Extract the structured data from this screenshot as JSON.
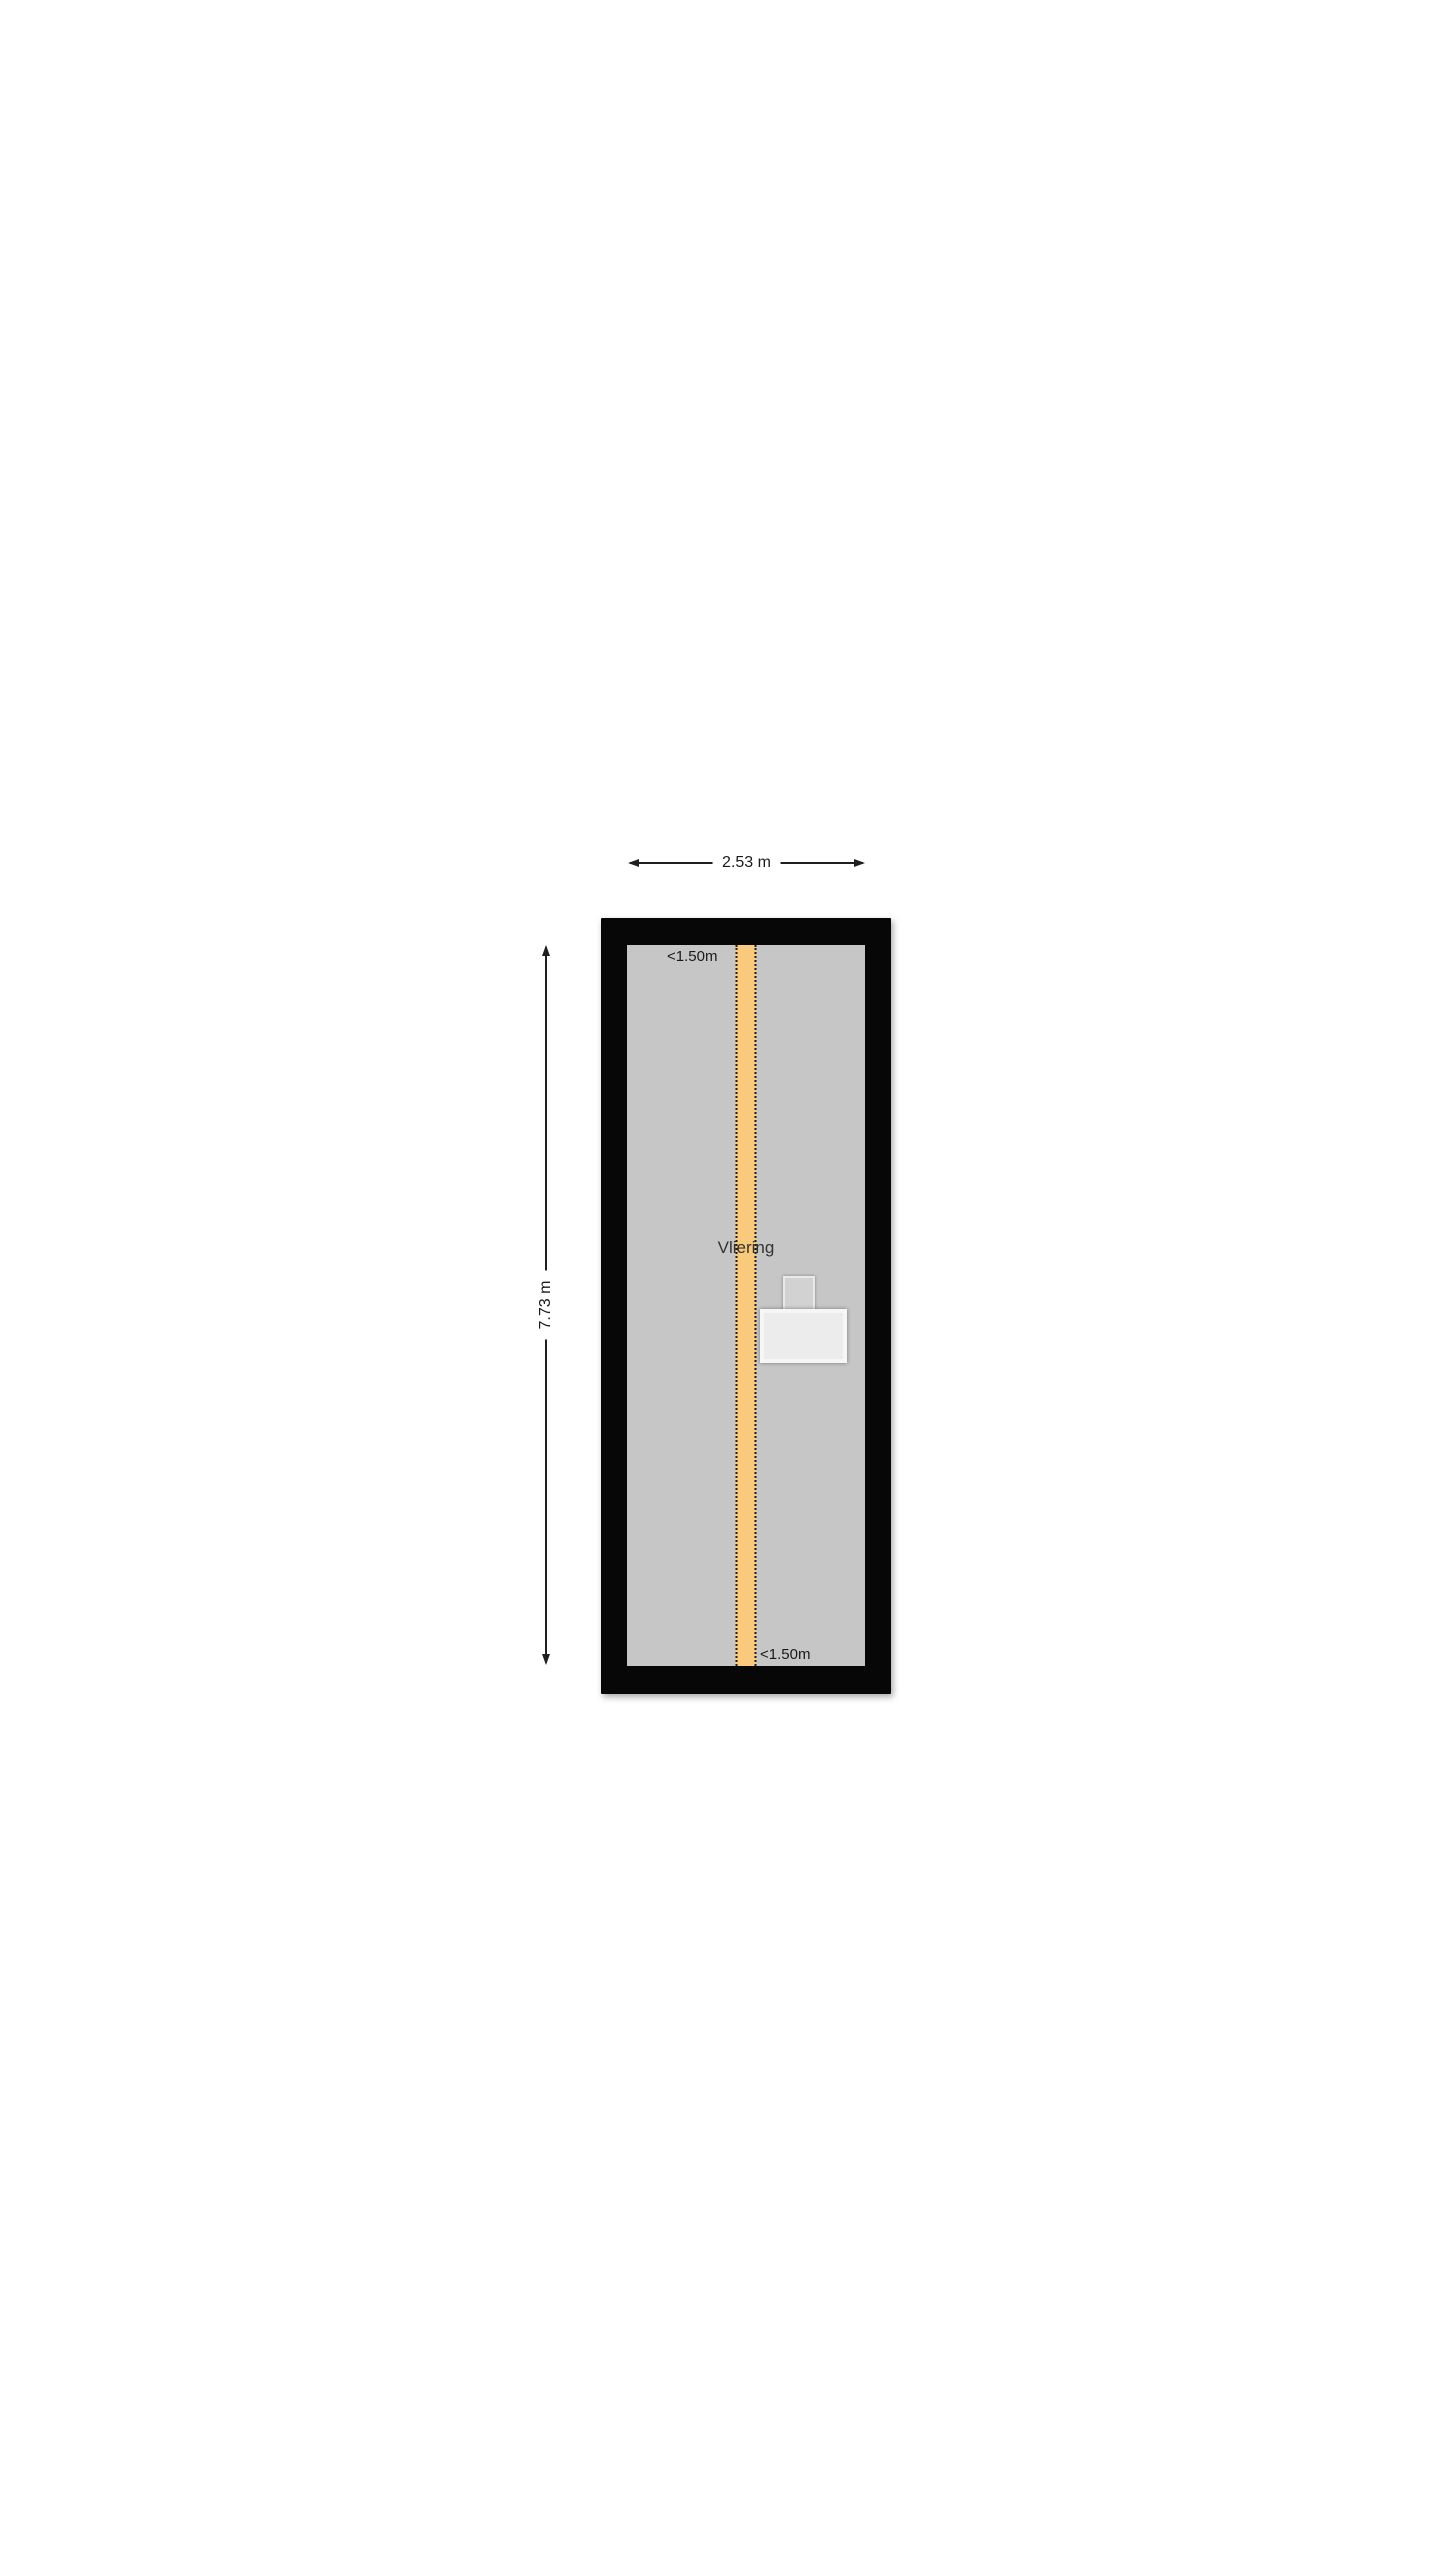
{
  "floorplan": {
    "room_label": "Vliering",
    "dimensions": {
      "width_label": "2.53 m",
      "height_label": "7.73 m"
    },
    "clearance": {
      "top_label": "<1.50m",
      "bottom_label": "<1.50m"
    },
    "colors": {
      "wall": "#070707",
      "floor": "#c6c6c6",
      "headroom_strip": "#f9ca7b",
      "dimension_line": "#1f1f1f",
      "background": "#ffffff"
    }
  }
}
